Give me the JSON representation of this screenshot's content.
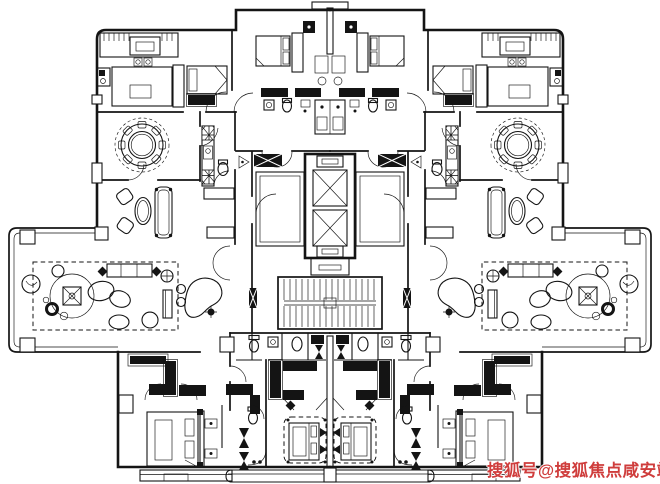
{
  "watermark": {
    "text": "搜狐号@搜狐焦点咸安站",
    "color": "#cf3d3c"
  },
  "canvas": {
    "width": 660,
    "height": 484,
    "background": "#ffffff",
    "line_color": "#141414"
  },
  "plan": {
    "type": "residential-floor-plan",
    "symmetry": "mirrored-left-right",
    "icons": [
      "dining-table-icon",
      "chair-icon",
      "sofa-icon",
      "armchair-icon",
      "coffee-table-icon",
      "bed-icon",
      "pillow-icon",
      "wardrobe-icon",
      "closet-xhatch-icon",
      "toilet-icon",
      "sink-icon",
      "shower-icon",
      "bathtub-bowtie-icon",
      "elevator-icon",
      "staircase-icon",
      "grand-piano-icon",
      "plant-icon",
      "rug-icon",
      "carpet-icon",
      "balcony-icon",
      "column-icon"
    ]
  }
}
